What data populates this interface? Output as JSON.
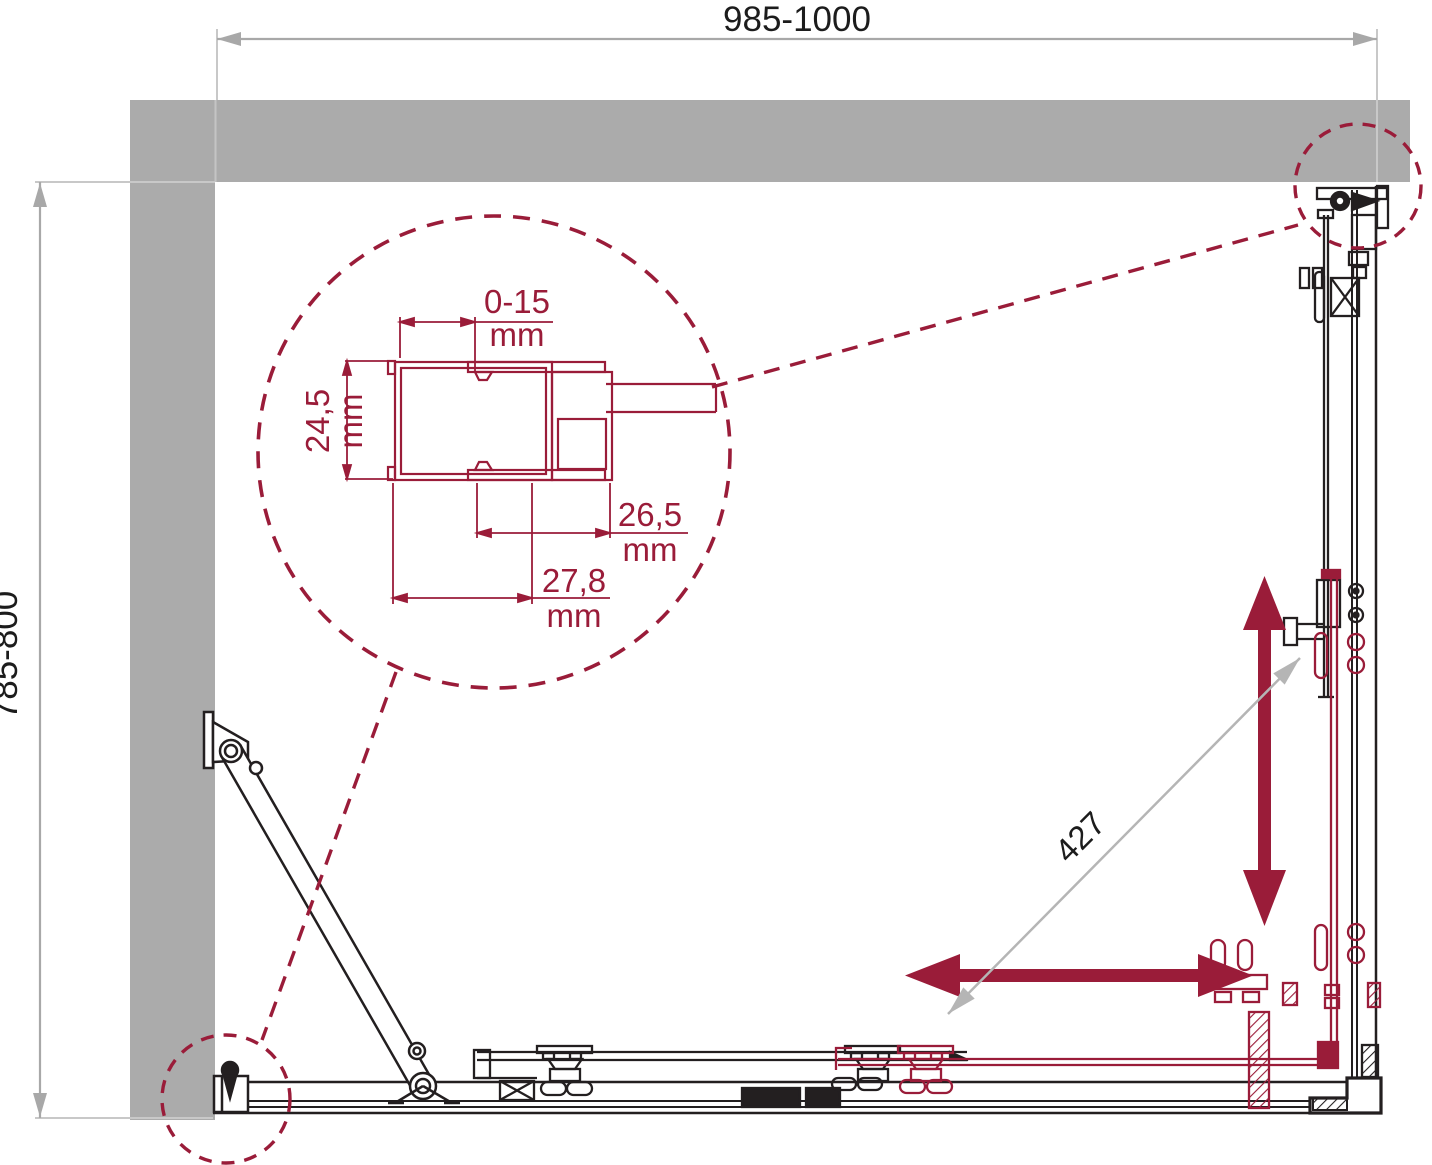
{
  "drawing_title": "Corner shower enclosure plan view technical drawing",
  "labels": {
    "width": "985-1000",
    "depth": "785-800",
    "opening": "427",
    "detail_adjust": "0-15",
    "detail_adjust_unit": "mm",
    "detail_depth": "24,5",
    "detail_depth_unit": "mm",
    "detail_width_inner": "26,5",
    "detail_width_inner_unit": "mm",
    "detail_width_outer": "27,8",
    "detail_width_outer_unit": "mm"
  },
  "colors": {
    "accent_maroon": "#9a1c39",
    "line_black": "#231f20",
    "wall_gray": "#ababab",
    "dimension_gray": "#a8a8a8",
    "extension_gray": "#c8c8c8",
    "diagonal_dim_gray": "#b5b5b5"
  }
}
